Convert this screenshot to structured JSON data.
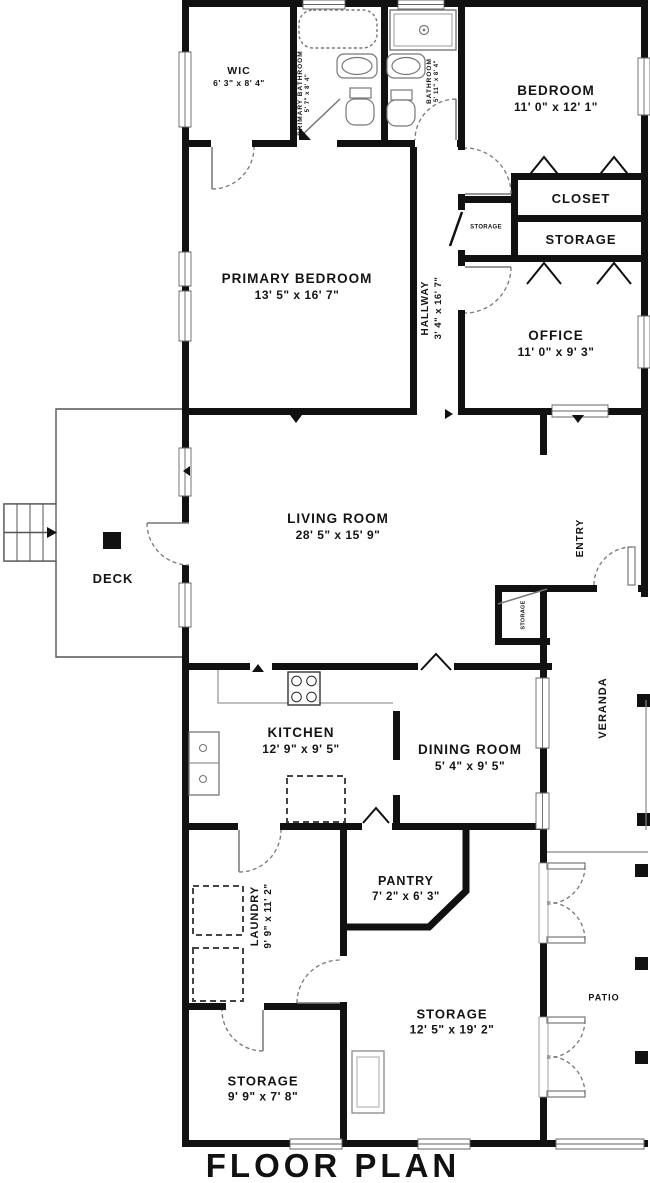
{
  "title": "FLOOR PLAN",
  "colors": {
    "wall": "#111111",
    "fixture": "#777777",
    "counter": "#999999",
    "floor": "#ffffff"
  },
  "rooms": {
    "wic": {
      "name": "WIC",
      "dims": "6' 3\" x 8' 4\""
    },
    "primary_bathroom": {
      "name": "PRIMARY BATHROOM",
      "dims": "5' 7\" x 8' 4\""
    },
    "bathroom": {
      "name": "BATHROOM",
      "dims": "5' 11\" x 8' 4\""
    },
    "bedroom": {
      "name": "BEDROOM",
      "dims": "11' 0\" x 12' 1\""
    },
    "closet": {
      "name": "CLOSET"
    },
    "storage_small": {
      "name": "STORAGE"
    },
    "storage_hall": {
      "name": "STORAGE"
    },
    "office": {
      "name": "OFFICE",
      "dims": "11' 0\" x 9' 3\""
    },
    "primary_bedroom": {
      "name": "PRIMARY BEDROOM",
      "dims": "13' 5\" x 16' 7\""
    },
    "hallway": {
      "name": "HALLWAY",
      "dims": "3' 4\" x 16' 7\""
    },
    "living_room": {
      "name": "LIVING ROOM",
      "dims": "28' 5\" x 15' 9\""
    },
    "deck": {
      "name": "DECK"
    },
    "entry": {
      "name": "ENTRY"
    },
    "storage_entry": {
      "name": "STORAGE"
    },
    "veranda": {
      "name": "VERANDA"
    },
    "kitchen": {
      "name": "KITCHEN",
      "dims": "12' 9\" x 9' 5\""
    },
    "dining_room": {
      "name": "DINING ROOM",
      "dims": "5' 4\" x 9' 5\""
    },
    "laundry": {
      "name": "LAUNDRY",
      "dims": "9' 9\" x 11' 2\""
    },
    "pantry": {
      "name": "PANTRY",
      "dims": "7' 2\" x 6' 3\""
    },
    "storage_large": {
      "name": "STORAGE",
      "dims": "12' 5\" x 19' 2\""
    },
    "storage_bottom": {
      "name": "STORAGE",
      "dims": "9' 9\" x 7' 8\""
    },
    "patio": {
      "name": "PATIO"
    }
  }
}
